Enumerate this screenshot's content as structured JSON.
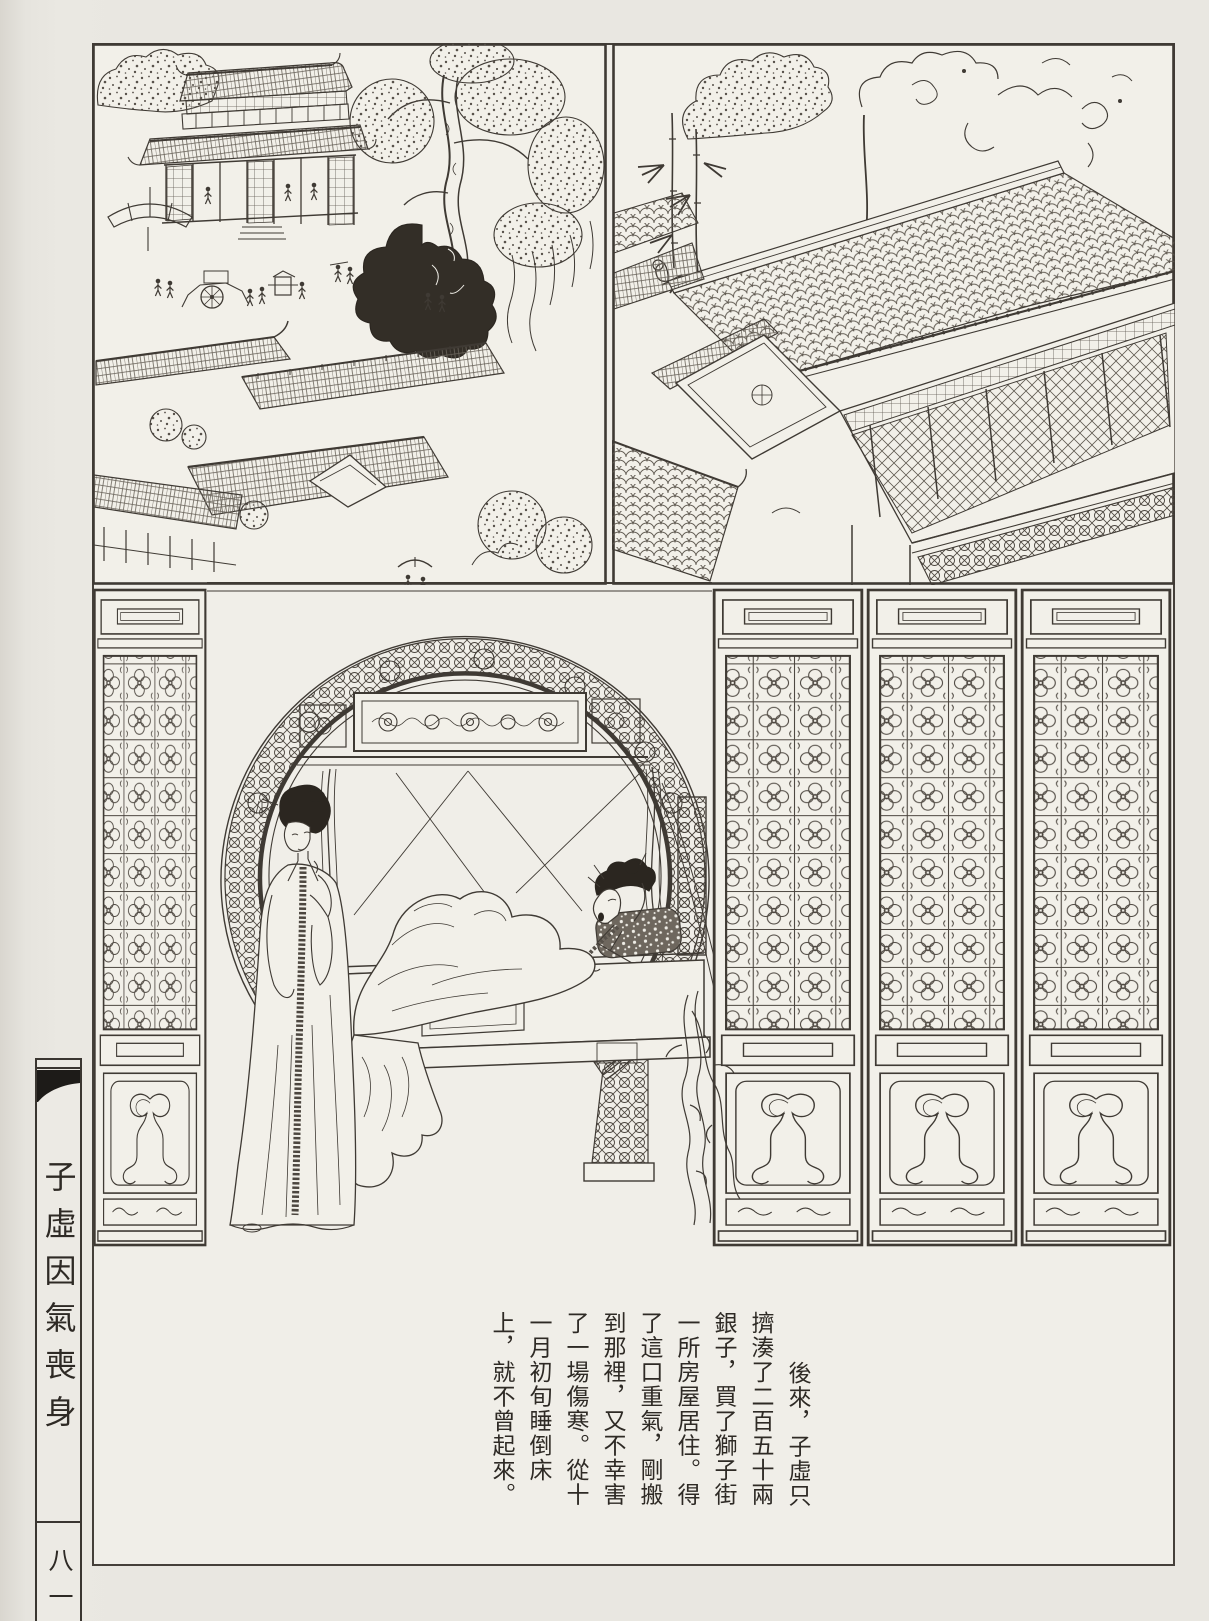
{
  "sidebar": {
    "series_title": "子虛因氣喪身",
    "page_number": "八一"
  },
  "caption": {
    "columns": [
      "後來，子虛只",
      "擠湊了二百五十兩",
      "銀子，買了獅子街",
      "一所房屋居住。得",
      "了這口重氣，剛搬",
      "到那裡，又不幸害",
      "了一場傷寒。從十",
      "一月初旬睡倒床",
      "上，就不曾起來。"
    ]
  },
  "colors": {
    "paper": "#e9e7e1",
    "plate_background": "#f0eee8",
    "ink": "#3f3a34",
    "ornament_black": "#1d1b18"
  }
}
